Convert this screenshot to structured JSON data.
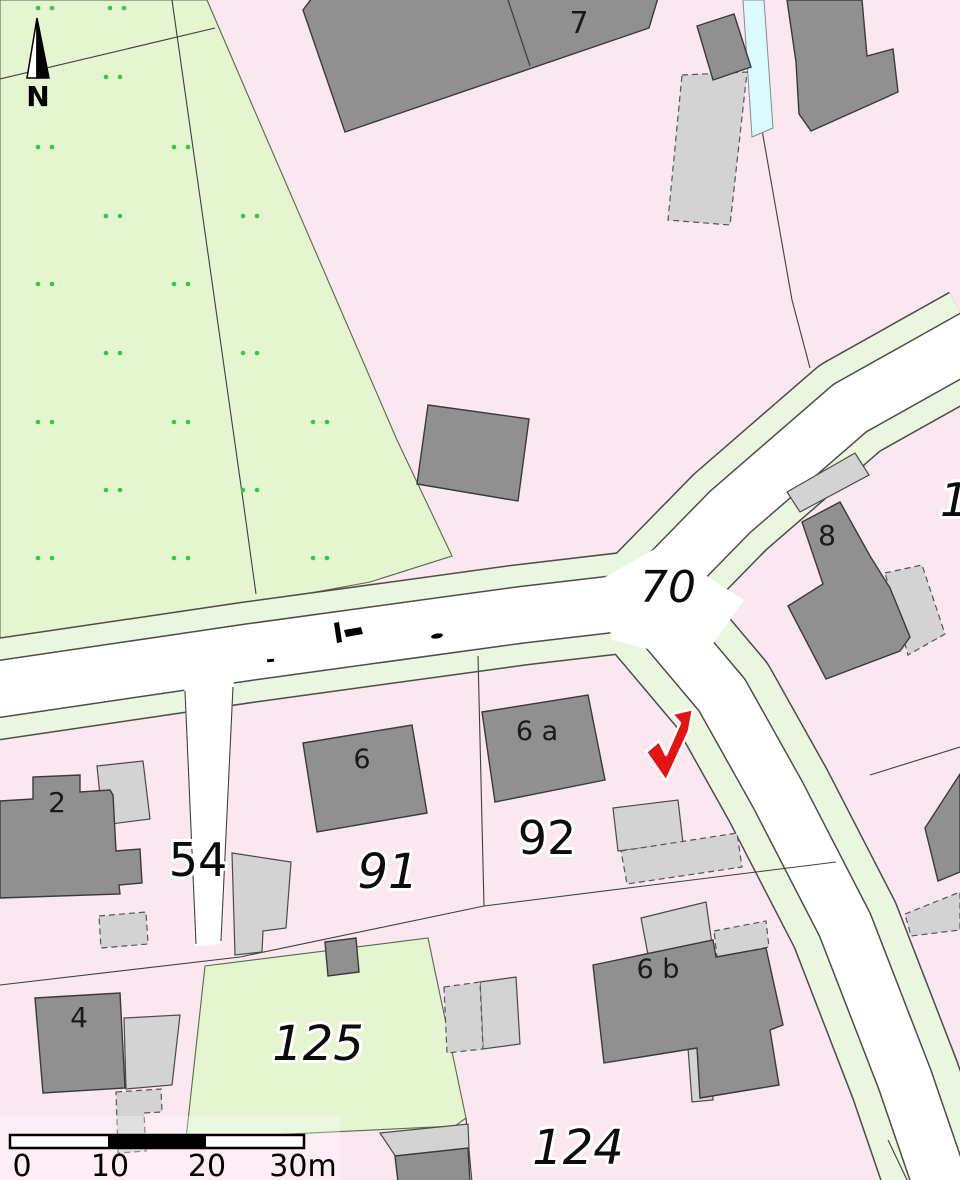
{
  "map": {
    "title": "cadastral-parcel-map",
    "north_arrow_label": "N",
    "parcels": {
      "road_70": "70",
      "path_54": "54",
      "p91": "91",
      "p92": "92",
      "p125": "125",
      "p124": "124",
      "edge_partial": "1"
    },
    "houses": {
      "h7": "7",
      "h2": "2",
      "h8": "8",
      "h6": "6",
      "h6a": "6 a",
      "h6b": "6 b",
      "h4": "4"
    },
    "scale_bar": {
      "ticks": [
        "0",
        "10",
        "20",
        "30m"
      ]
    },
    "marker": {
      "name": "red-checkmark",
      "color": "#e51414"
    },
    "colors": {
      "parcel_pink": "#fbe7ef",
      "field_green": "#e4f5d0",
      "verge_green": "#eaf7de",
      "road_white": "#ffffff",
      "building_dark": "#909090",
      "building_light": "#d3d3d3",
      "water_blue": "#d9fbfd",
      "dot_green": "#2ecc40",
      "outline_dark": "#3f3f3f"
    }
  }
}
